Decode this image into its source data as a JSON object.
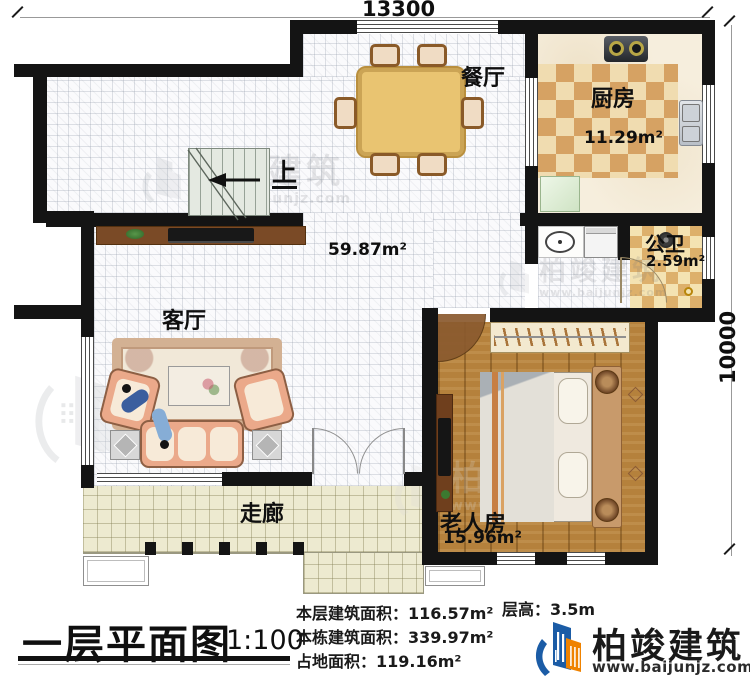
{
  "dimensions": {
    "top": "13300",
    "right": "10000"
  },
  "rooms": {
    "dining": {
      "label": "餐厅"
    },
    "kitchen": {
      "label": "厨房",
      "area": "11.29m²"
    },
    "bathroom": {
      "label": "公卫",
      "area": "2.59m²"
    },
    "hall": {
      "area": "59.87m²"
    },
    "living": {
      "label": "客厅"
    },
    "bedroom": {
      "label": "老人房",
      "area": "15.96m²"
    },
    "corridor": {
      "label": "走廊"
    },
    "stairs": {
      "up_label": "上"
    }
  },
  "title": {
    "text": "一层平面图",
    "scale": "1:100"
  },
  "stats": {
    "floor_area_label": "本层建筑面积：",
    "floor_area_value": "116.57m²",
    "building_area_label": "本栋建筑面积：",
    "building_area_value": "339.97m²",
    "footprint_label": "占地面积：",
    "footprint_value": "119.16m²",
    "storey_height_label": "层高：",
    "storey_height_value": "3.5m"
  },
  "brand": {
    "name": "柏竣建筑",
    "url": "www.baijunjz.com"
  },
  "colors": {
    "wall": "#141414",
    "brand_blue": "#1b5ca6",
    "brand_orange": "#ef8200",
    "kitchen_checker": "#d6a263",
    "corridor_tile": "#edead0",
    "wood_floor": "#b5813c"
  }
}
